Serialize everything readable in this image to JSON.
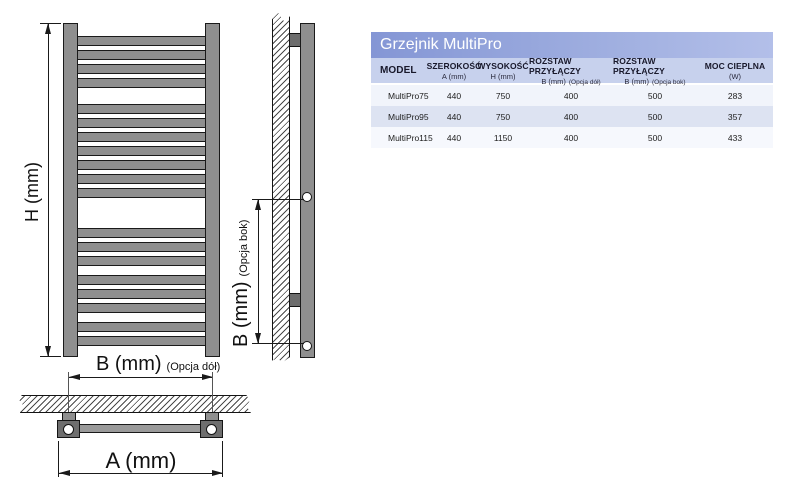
{
  "table": {
    "title": "Grzejnik MultiPro",
    "columns": [
      {
        "title": "MODEL",
        "sub": "",
        "note": ""
      },
      {
        "title": "SZEROKOŚĆ",
        "sub": "A (mm)",
        "note": ""
      },
      {
        "title": "WYSOKOŚĆ",
        "sub": "H (mm)",
        "note": ""
      },
      {
        "title": "ROZSTAW PRZYŁĄCZY",
        "sub": "B (mm)",
        "note": "(Opcja dół)"
      },
      {
        "title": "ROZSTAW PRZYŁĄCZY",
        "sub": "B (mm)",
        "note": "(Opcja bok)"
      },
      {
        "title": "MOC CIEPLNA",
        "sub": "(W)",
        "note": ""
      }
    ],
    "rows": [
      [
        "MultiPro75",
        "440",
        "750",
        "400",
        "500",
        "283"
      ],
      [
        "MultiPro95",
        "440",
        "750",
        "400",
        "500",
        "357"
      ],
      [
        "MultiPro115",
        "440",
        "1150",
        "400",
        "500",
        "433"
      ]
    ]
  },
  "diagram": {
    "h_label": "H (mm)",
    "a_label": "A (mm)",
    "b_bottom_label": "B (mm)",
    "b_bottom_note": "(Opcja dół)",
    "b_side_label": "B (mm)",
    "b_side_note": "(Opcja bok)",
    "rungs": [
      36,
      50,
      64,
      78,
      104,
      118,
      132,
      146,
      160,
      174,
      188,
      228,
      242,
      256,
      275,
      289,
      303,
      322,
      336
    ]
  },
  "colors": {
    "radiator_gray": "#8f8f8f",
    "fitting_gray": "#6e6e6e",
    "outline": "#1a1a1a",
    "title_gradient_start": "#8496d5",
    "title_gradient_end": "#b3bfe9",
    "header_bg": "#c7d1ed",
    "row_bg": "#f1f4fb",
    "row_alt_bg": "#dde3f2"
  }
}
